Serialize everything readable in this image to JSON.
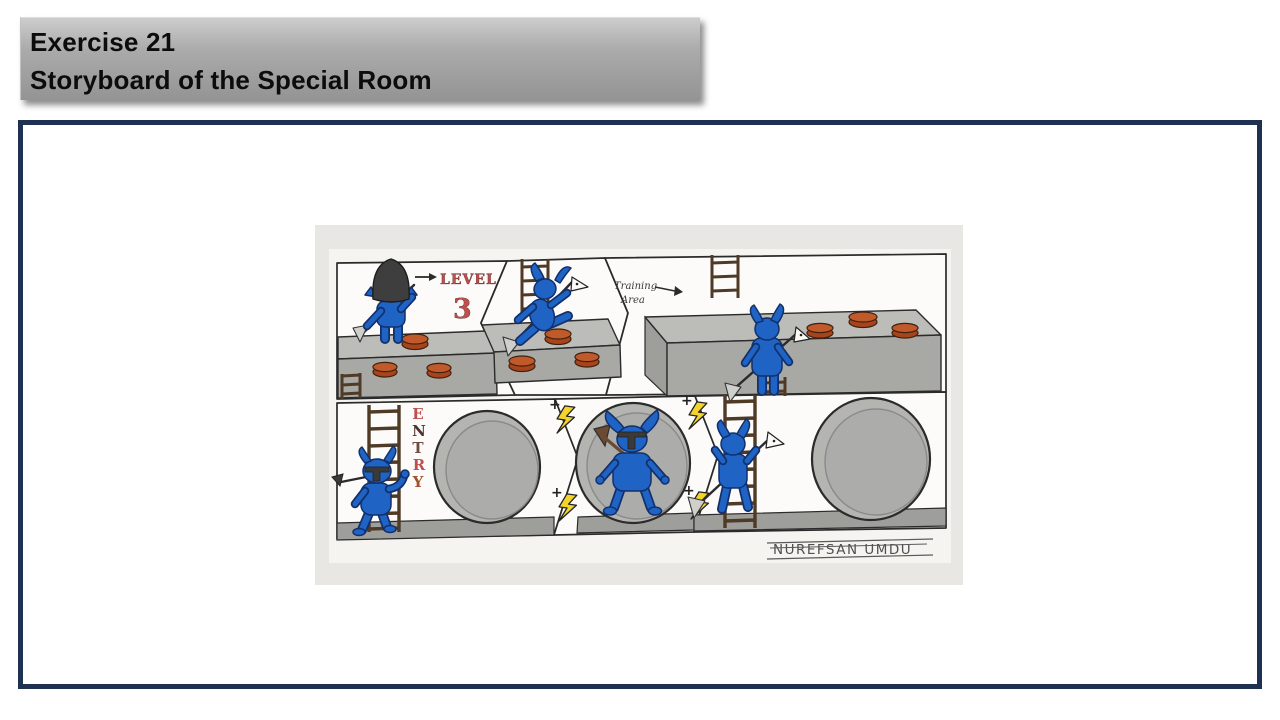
{
  "header": {
    "line1": "Exercise 21",
    "line2": "Storyboard of the Special Room"
  },
  "storyboard": {
    "level_label": "LEVEL",
    "level_number": "3",
    "training_line1": "Training",
    "training_line2": "Area",
    "entry": [
      "E",
      "N",
      "T",
      "R",
      "Y"
    ],
    "plus": "+",
    "signature": "NUREFSAN UMDU"
  },
  "colors": {
    "frame-navy": "#1e3150",
    "photo-bg": "#e9e7e4",
    "paper": "#f6f4f0",
    "goblin-blue": "#1f63c4",
    "goblin-outline": "#12306b",
    "platform-gray": "#bcbcb9",
    "platform-front": "#a8a8a5",
    "disc-orange": "#c05a2a",
    "disc-side": "#a8441c",
    "ladder-brown": "#4f3a26",
    "bolt-yellow": "#f2d42a",
    "label-red": "#bf4f4c"
  }
}
